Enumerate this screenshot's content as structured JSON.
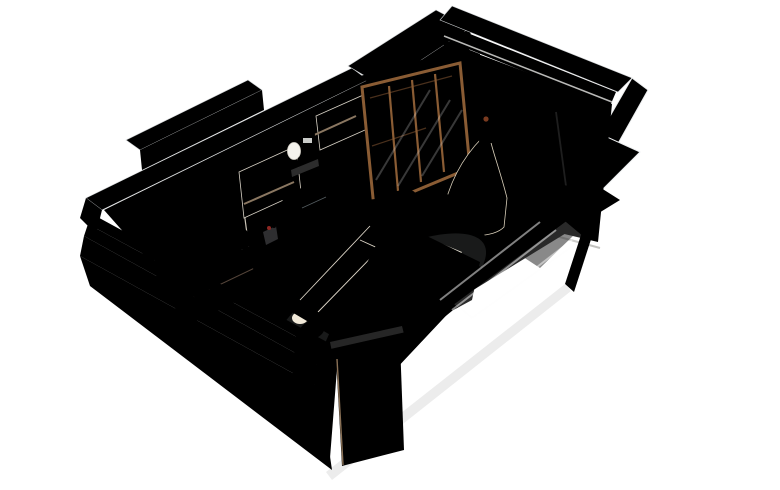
{
  "scene": {
    "description": "Isometric cutaway 3D render of a bedroom interior",
    "tv": {
      "logo": "SKYDANCE"
    }
  },
  "palette": {
    "bg": "#ffffff",
    "wallTop": "#f0f1f3",
    "wallTopEdge": "#d3d6d9",
    "wallFace": "#d8dade",
    "wallFaceLight": "#e3e5e8",
    "wallOuterGray": "#c5c8cc",
    "grayChunk": "#cdd0d3",
    "floor": "#cfd1d3",
    "floorLine": "#c0c3c5",
    "floorLight": "#dadbdc",
    "woodDark": "#5e4c3d",
    "woodDark2": "#4f3e30",
    "wood": "#74604f",
    "woodTop": "#7d6a58",
    "cabinetWhite": "#e9e5dc",
    "cabinetWhite2": "#f0ece4",
    "carcass": "#6b5a48",
    "wardrobeAmber": "#8a5c34",
    "wardrobeAmberDark": "#6e4526",
    "wardrobeGlow": "#b5823f",
    "mirrorTeal": "#274b43",
    "clothesTan": "#c8a87e",
    "clothesCream": "#ddc6a4",
    "foldedOrange": "#a85a2a",
    "tvDark": "#16232b",
    "tvGlow": "#2c4250",
    "tvText": "#d8dde0",
    "valance": "#3a4046",
    "drapeGray": "#8e8d8b",
    "drapeGrayDark": "#767573",
    "sheer": "#f1efe9",
    "sheerLine": "#dfdcd3",
    "blanket": "#8a4a21",
    "blanketDark": "#6c3916",
    "blanketLight": "#a25a28",
    "mattress": "#efe9df",
    "bedTrim": "#cdb699",
    "bedTrimLight": "#e2cfae",
    "rugWhite": "#f3f1ec",
    "rugBlack": "#2e2c2a",
    "platform1": "#6f5840",
    "platform2": "#7f664a",
    "platform3": "#8f755a",
    "platformTop": "#9a8064",
    "dress": "#ece4d3",
    "dressShade": "#d9cfba",
    "bodice": "#3c3531",
    "lamp": "#1e1e1e",
    "doorWood": "#6b5140",
    "doorGrain": "#5a4233",
    "panelWood": "#6d5847",
    "panelWhite": "#eceae6",
    "panelDark": "#4a4d52",
    "plantGreen": "#4a7a4e",
    "plantGreen2": "#5f8f57",
    "flowerRed": "#b0322a",
    "handleDark": "#161616"
  },
  "books": {
    "top_shelf": [
      "#b5402c",
      "#d97f2e",
      "#2f5876",
      "#26405e",
      "#7a3b2e",
      "#3f7068",
      "#8a5f9e",
      "#c23b4e",
      "#36454f"
    ],
    "lower_shelf": [
      "#c1452f",
      "#d98431",
      "#31547a",
      "#7a3b2e",
      "#3f7068",
      "#8a5f9e",
      "#b8860b",
      "#2e6e5e",
      "#9c4722",
      "#274060"
    ]
  },
  "wardrobe_clothes": {
    "row1": [
      "#c8a87e",
      "#ddc6a4",
      "#b99a72",
      "#d4b98f",
      "#c8a87e",
      "#e0cba8",
      "#bd9d74",
      "#d2b68c",
      "#c4a077",
      "#d9c09b"
    ],
    "row2": [
      "#ddc6a4",
      "#c8a87e",
      "#d4b98f",
      "#bd9d74",
      "#dcc5a2",
      "#c8a87e"
    ],
    "folded": [
      "#a85a2a",
      "#c27a3d",
      "#a85a2a",
      "#d9c4a4",
      "#b06030"
    ]
  }
}
